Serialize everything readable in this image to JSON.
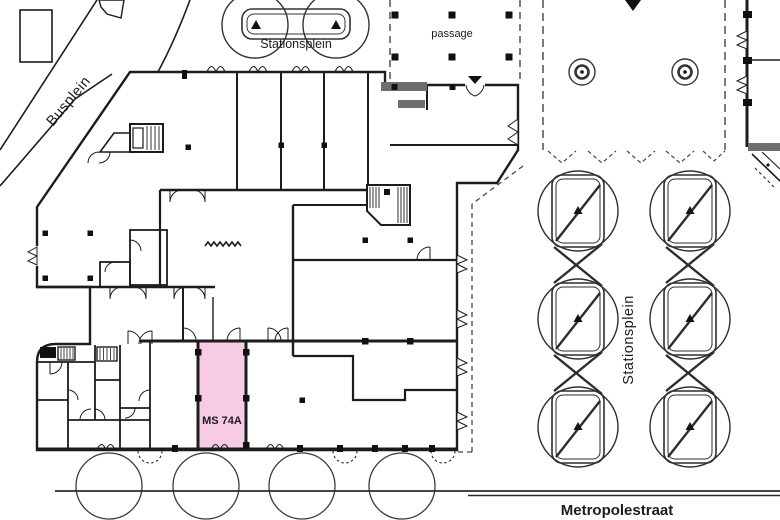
{
  "labels": {
    "busplein": "Busplein",
    "stationsplein_north": "Stationsplein",
    "passage": "passage",
    "stationsplein_east": "Stationsplein",
    "metropolestraat": "Metropolestraat"
  },
  "highlighted_unit": {
    "label": "MS 74A",
    "fill_color": "#f6cbe3",
    "label_color": "#59384a"
  },
  "colors": {
    "line": "#1c1c1c",
    "background": "#ffffff"
  }
}
